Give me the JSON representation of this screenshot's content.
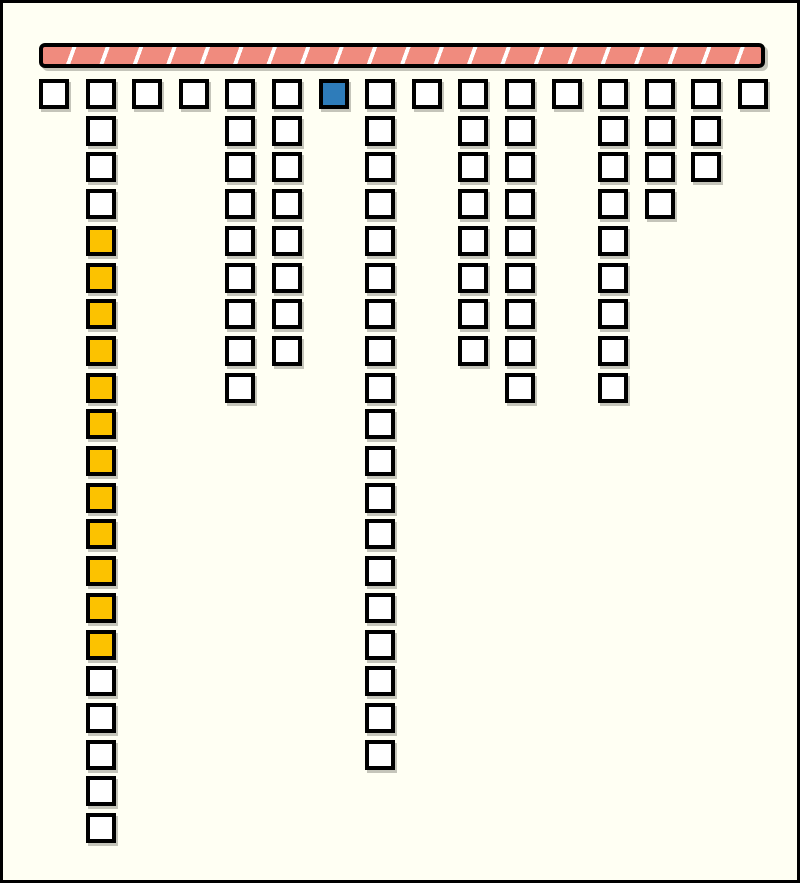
{
  "canvas": {
    "width": 800,
    "height": 883,
    "background": "#FFFFF3",
    "frame_border": "#000000"
  },
  "colors": {
    "ink": "#000000",
    "paper": "#FFFFF3",
    "cell_default": "#FFFFFF",
    "cell_highlight": "#FCC200",
    "cell_active": "#2E7CBA",
    "bar_fill": "#F08B7E",
    "bar_gap": "#FFFFFF",
    "shadow": "rgba(90,90,80,0.35)"
  },
  "layout": {
    "bar": {
      "x": 36,
      "y": 40,
      "width": 726,
      "height": 25,
      "segment_count": 22,
      "stripe_angle_deg": 110,
      "stripe_width": 27.5,
      "stripe_pitch": 31.4
    },
    "grid": {
      "origin_x": 36,
      "origin_y": 76,
      "col_pitch": 46.6,
      "row_pitch": 36.7,
      "cell_size": 30,
      "column_count": 16
    }
  },
  "columns": [
    {
      "id": 1,
      "cells": [
        "default"
      ]
    },
    {
      "id": 2,
      "cells": [
        "default",
        "default",
        "default",
        "default",
        "highlight",
        "highlight",
        "highlight",
        "highlight",
        "highlight",
        "highlight",
        "highlight",
        "highlight",
        "highlight",
        "highlight",
        "highlight",
        "highlight",
        "default",
        "default",
        "default",
        "default",
        "default"
      ]
    },
    {
      "id": 3,
      "cells": [
        "default"
      ]
    },
    {
      "id": 4,
      "cells": [
        "default"
      ]
    },
    {
      "id": 5,
      "cells": [
        "default",
        "default",
        "default",
        "default",
        "default",
        "default",
        "default",
        "default",
        "default"
      ]
    },
    {
      "id": 6,
      "cells": [
        "default",
        "default",
        "default",
        "default",
        "default",
        "default",
        "default",
        "default"
      ]
    },
    {
      "id": 7,
      "cells": [
        "active"
      ]
    },
    {
      "id": 8,
      "cells": [
        "default",
        "default",
        "default",
        "default",
        "default",
        "default",
        "default",
        "default",
        "default",
        "default",
        "default",
        "default",
        "default",
        "default",
        "default",
        "default",
        "default",
        "default",
        "default"
      ]
    },
    {
      "id": 9,
      "cells": [
        "default"
      ]
    },
    {
      "id": 10,
      "cells": [
        "default",
        "default",
        "default",
        "default",
        "default",
        "default",
        "default",
        "default"
      ]
    },
    {
      "id": 11,
      "cells": [
        "default",
        "default",
        "default",
        "default",
        "default",
        "default",
        "default",
        "default",
        "default"
      ]
    },
    {
      "id": 12,
      "cells": [
        "default"
      ]
    },
    {
      "id": 13,
      "cells": [
        "default",
        "default",
        "default",
        "default",
        "default",
        "default",
        "default",
        "default",
        "default"
      ]
    },
    {
      "id": 14,
      "cells": [
        "default",
        "default",
        "default",
        "default"
      ]
    },
    {
      "id": 15,
      "cells": [
        "default",
        "default",
        "default"
      ]
    },
    {
      "id": 16,
      "cells": [
        "default"
      ]
    }
  ]
}
